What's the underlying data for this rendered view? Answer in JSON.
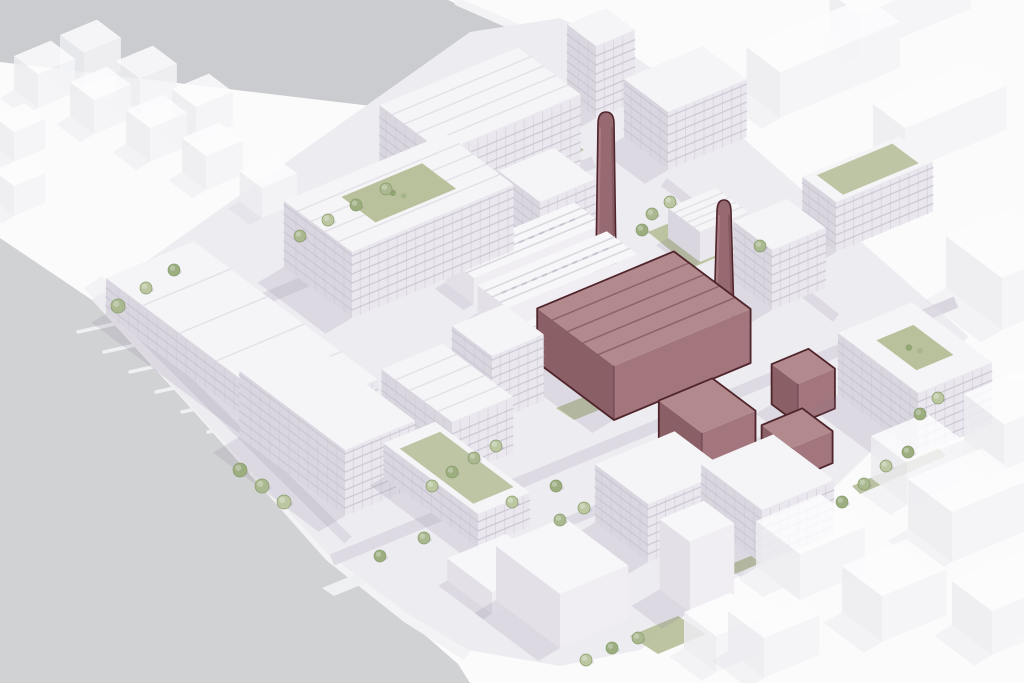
{
  "meta": {
    "kind": "architectural-axonometric-masterplan-rendering",
    "description_tokens": [
      "riverside-masterplan",
      "highlighted-heritage-power-station",
      "two-chimneys",
      "context-massing"
    ],
    "visible_text": []
  },
  "palette": {
    "background": "#fbfbfc",
    "water": "#d1d2d4",
    "top_band": "#c8c9cc",
    "quay": "#f3f2f4",
    "site_ground": "#edecf1",
    "street": "#dcd9e2",
    "lawn": "#b9c19c",
    "green_roof": "#bdc5a5",
    "tree_greens": [
      "#aab88f",
      "#bcc7a2",
      "#9cad80"
    ],
    "tree_stroke": "#879c6a",
    "building_top": "#f5f4f6",
    "building_se": "#eae8ee",
    "building_sw": "#d9d6df",
    "floor_band": "#c9c6d3",
    "mullion": "#c3c0cd",
    "massing_top": "#f7f6f8",
    "massing_se": "#f0eef3",
    "massing_sw": "#e3e0e8",
    "context_top": "#fdfdfe",
    "context_se": "#f5f5f8",
    "context_sw": "#ededf1",
    "roof_stripe": "#dedbe4",
    "shed_ridge": "#d8d5de",
    "skylight": "#b9b6c4",
    "highlight_top": "#b28a8e",
    "highlight_se": "#a2767c",
    "highlight_sw": "#8a5f66",
    "highlight_stripe": "#7c525a",
    "highlight_outline": "#4f242b",
    "chimney_fill": "#976a71",
    "chimney_light": "#ad8187",
    "chimney_dark": "#7b5158",
    "shadow": "rgba(128,120,150,0.16)"
  },
  "scene": {
    "canvas": {
      "w": 1024,
      "h": 683
    },
    "top_band": {
      "poly": [
        [
          0,
          0
        ],
        [
          448,
          0
        ],
        [
          676,
          102
        ],
        [
          608,
          134
        ],
        [
          0,
          62
        ]
      ],
      "stripe": [
        [
          458,
          2
        ],
        [
          690,
          103
        ]
      ]
    },
    "water": {
      "poly": [
        [
          0,
          238
        ],
        [
          92,
          300
        ],
        [
          330,
          560
        ],
        [
          410,
          622
        ],
        [
          458,
          664
        ],
        [
          470,
          683
        ],
        [
          0,
          683
        ]
      ]
    },
    "quay": {
      "poly": [
        [
          84,
          288
        ],
        [
          102,
          276
        ],
        [
          344,
          544
        ],
        [
          424,
          608
        ],
        [
          474,
          646
        ],
        [
          464,
          660
        ],
        [
          404,
          622
        ],
        [
          326,
          560
        ]
      ]
    },
    "piers": {
      "bases": [
        [
          114,
          324
        ],
        [
          140,
          344
        ],
        [
          166,
          364
        ],
        [
          192,
          384
        ],
        [
          218,
          404
        ],
        [
          244,
          424
        ],
        [
          270,
          444
        ]
      ],
      "dir": [
        -36,
        8
      ]
    },
    "steps": {
      "count": 5,
      "start": [
        386,
        566
      ],
      "step": [
        8,
        6
      ],
      "vec": [
        78,
        -33
      ]
    },
    "pontoons": [
      [
        [
          322,
          588
        ],
        [
          390,
          560
        ],
        [
          402,
          568
        ],
        [
          334,
          596
        ]
      ],
      [
        [
          530,
          654
        ],
        [
          596,
          626
        ],
        [
          608,
          634
        ],
        [
          542,
          662
        ]
      ]
    ],
    "ground": {
      "poly": [
        [
          92,
          300
        ],
        [
          470,
          32
        ],
        [
          560,
          18
        ],
        [
          612,
          42
        ],
        [
          700,
          100
        ],
        [
          968,
          336
        ],
        [
          930,
          394
        ],
        [
          760,
          560
        ],
        [
          640,
          650
        ],
        [
          560,
          666
        ],
        [
          468,
          650
        ],
        [
          408,
          614
        ],
        [
          328,
          554
        ]
      ]
    },
    "streets": [
      {
        "p1": [
          150,
          346
        ],
        "p2": [
          594,
          162
        ],
        "w": 12
      },
      {
        "p1": [
          332,
          560
        ],
        "p2": [
          956,
          302
        ],
        "w": 12
      },
      {
        "p1": [
          452,
          238
        ],
        "p2": [
          636,
          382
        ],
        "w": 10
      },
      {
        "p1": [
          252,
          312
        ],
        "p2": [
          430,
          448
        ],
        "w": 10
      },
      {
        "p1": [
          664,
          182
        ],
        "p2": [
          836,
          318
        ],
        "w": 10
      },
      {
        "p1": [
          548,
          530
        ],
        "p2": [
          770,
          438
        ],
        "w": 10
      },
      {
        "p1": [
          108,
          302
        ],
        "p2": [
          348,
          540
        ],
        "w": 10
      }
    ],
    "greens": [
      {
        "n": "north-courtyard-lawn",
        "poly": [
          [
            648,
            232
          ],
          [
            712,
            205
          ],
          [
            756,
            240
          ],
          [
            692,
            268
          ]
        ]
      },
      {
        "n": "south-lawn",
        "poly": [
          [
            630,
            636
          ],
          [
            678,
            616
          ],
          [
            706,
            634
          ],
          [
            658,
            654
          ]
        ]
      },
      {
        "n": "southeast-verge",
        "poly": [
          [
            712,
            572
          ],
          [
            804,
            534
          ],
          [
            812,
            542
          ],
          [
            720,
            580
          ]
        ]
      },
      {
        "n": "east-verge",
        "poly": [
          [
            852,
            486
          ],
          [
            938,
            448
          ],
          [
            946,
            456
          ],
          [
            860,
            494
          ]
        ]
      },
      {
        "n": "central-lawn",
        "poly": [
          [
            556,
            408
          ],
          [
            596,
            392
          ],
          [
            614,
            404
          ],
          [
            574,
            420
          ]
        ]
      },
      {
        "n": "upper-courtyard-lawn",
        "poly": [
          [
            520,
            150
          ],
          [
            560,
            134
          ],
          [
            584,
            150
          ],
          [
            544,
            166
          ]
        ]
      }
    ],
    "context_blocks": [
      [
        38,
        108,
        40,
        30,
        34
      ],
      [
        94,
        134,
        40,
        30,
        34
      ],
      [
        150,
        162,
        40,
        30,
        34
      ],
      [
        206,
        190,
        40,
        30,
        34
      ],
      [
        262,
        218,
        38,
        28,
        30
      ],
      [
        84,
        87,
        40,
        30,
        34
      ],
      [
        140,
        113,
        40,
        30,
        34
      ],
      [
        196,
        141,
        40,
        30,
        34
      ],
      [
        14,
        162,
        34,
        26,
        30
      ],
      [
        14,
        216,
        34,
        26,
        30
      ],
      [
        780,
        118,
        130,
        42,
        46
      ],
      [
        905,
        172,
        110,
        40,
        44
      ],
      [
        860,
        55,
        120,
        38,
        40
      ],
      [
        1002,
        330,
        70,
        70,
        52
      ],
      [
        800,
        600,
        70,
        55,
        46
      ],
      [
        882,
        642,
        70,
        50,
        46
      ],
      [
        952,
        562,
        80,
        55,
        50
      ],
      [
        907,
        505,
        60,
        45,
        42
      ],
      [
        1004,
        470,
        60,
        50,
        46
      ],
      [
        764,
        678,
        60,
        45,
        40
      ],
      [
        992,
        655,
        70,
        50,
        44
      ],
      [
        716,
        672,
        50,
        40,
        36
      ]
    ],
    "buildings": [
      {
        "n": "west-warehouses",
        "s": [
          290,
          452
        ],
        "a": 95,
        "b": 230,
        "h": 36,
        "st": "det",
        "fl": true,
        "roof": "gable"
      },
      {
        "n": "northwest-perimeter-block",
        "s": [
          352,
          318
        ],
        "a": 175,
        "b": 85,
        "h": 66,
        "st": "det",
        "fl": true,
        "roof": "gable",
        "ct": true
      },
      {
        "n": "northwest-upper-block",
        "s": [
          442,
          226
        ],
        "a": 150,
        "b": 78,
        "h": 74,
        "st": "det",
        "fl": true,
        "roof": "gable"
      },
      {
        "n": "north-tower",
        "s": [
          596,
          118
        ],
        "a": 42,
        "b": 36,
        "h": 72,
        "st": "det",
        "fl": true
      },
      {
        "n": "north-block",
        "s": [
          668,
          170
        ],
        "a": 85,
        "b": 55,
        "h": 58,
        "st": "det",
        "fl": true
      },
      {
        "n": "northeast-bar",
        "s": [
          836,
          252
        ],
        "a": 105,
        "b": 42,
        "h": 50,
        "st": "det",
        "fl": true,
        "gr": true
      },
      {
        "n": "northeast-block",
        "s": [
          772,
          310
        ],
        "a": 58,
        "b": 48,
        "h": 60,
        "st": "det",
        "fl": true
      },
      {
        "n": "east-perimeter-block",
        "s": [
          918,
          455
        ],
        "a": 80,
        "b": 100,
        "h": 62,
        "st": "det",
        "fl": true,
        "ct": true
      },
      {
        "n": "waterfront-slab",
        "s": [
          345,
          516
        ],
        "a": 76,
        "b": 132,
        "h": 66,
        "st": "det",
        "fl": true
      },
      {
        "n": "south-terraced-block",
        "s": [
          452,
          478
        ],
        "a": 66,
        "b": 88,
        "h": 56,
        "st": "det",
        "fl": true,
        "roof": "gable"
      },
      {
        "n": "south-green-roof-bar",
        "s": [
          478,
          548
        ],
        "a": 56,
        "b": 118,
        "h": 34,
        "st": "det",
        "fl": true,
        "gr": true
      },
      {
        "n": "southeast-block-a",
        "s": [
          648,
          562
        ],
        "a": 86,
        "b": 66,
        "h": 58,
        "st": "det",
        "fl": true
      },
      {
        "n": "southeast-block-b",
        "s": [
          762,
          564
        ],
        "a": 78,
        "b": 76,
        "h": 54,
        "st": "det",
        "fl": true
      },
      {
        "n": "central-midrise",
        "s": [
          492,
          422
        ],
        "a": 56,
        "b": 50,
        "h": 66,
        "st": "det",
        "fl": true
      },
      {
        "n": "industrial-shed-a",
        "s": [
          508,
          336
        ],
        "a": 140,
        "b": 38,
        "h": 28,
        "st": "massing",
        "roof": "shed"
      },
      {
        "n": "industrial-shed-b",
        "s": [
          474,
          304
        ],
        "a": 140,
        "b": 36,
        "h": 26,
        "st": "massing",
        "roof": "shed"
      },
      {
        "n": "industrial-shed-c",
        "s": [
          545,
          372
        ],
        "a": 80,
        "b": 34,
        "h": 26,
        "st": "massing",
        "roof": "shed"
      },
      {
        "n": "south-massing-large",
        "s": [
          560,
          648
        ],
        "a": 74,
        "b": 80,
        "h": 54,
        "st": "massing"
      },
      {
        "n": "south-massing-tower",
        "s": [
          690,
          612
        ],
        "a": 48,
        "b": 38,
        "h": 70,
        "st": "massing"
      },
      {
        "n": "south-massing-podium",
        "s": [
          492,
          614
        ],
        "a": 64,
        "b": 56,
        "h": 22,
        "st": "massing"
      },
      {
        "n": "courtyard-cottages",
        "s": [
          700,
          262
        ],
        "a": 52,
        "b": 40,
        "h": 30,
        "st": "det",
        "roof": "gable"
      },
      {
        "n": "north-mid-block",
        "s": [
          540,
          262
        ],
        "a": 60,
        "b": 52,
        "h": 60,
        "st": "det",
        "fl": true
      }
    ],
    "factory": {
      "halls": [
        {
          "n": "power-station-main-hall",
          "s": [
            614,
            420
          ],
          "a": 148,
          "b": 96,
          "h": 54,
          "st": "maroon",
          "roof": "gable"
        },
        {
          "n": "power-station-south-annex",
          "s": [
            702,
            477
          ],
          "a": 58,
          "b": 54,
          "h": 44,
          "st": "maroon"
        },
        {
          "n": "power-station-east-annex",
          "s": [
            798,
            424
          ],
          "a": 40,
          "b": 33,
          "h": 40,
          "st": "maroon"
        },
        {
          "n": "power-station-small-annex",
          "s": [
            792,
            480
          ],
          "a": 44,
          "b": 38,
          "h": 32,
          "st": "maroon"
        }
      ],
      "chimneys": [
        {
          "n": "chimney-west",
          "x": 606,
          "top": 112,
          "base": 330,
          "wt": 8,
          "wb": 11
        },
        {
          "n": "chimney-east",
          "x": 724,
          "top": 200,
          "base": 316,
          "wt": 7,
          "wb": 10
        }
      ]
    },
    "trees": [
      [
        118,
        306,
        7
      ],
      [
        146,
        288,
        6
      ],
      [
        174,
        270,
        6
      ],
      [
        300,
        236,
        6
      ],
      [
        328,
        220,
        6
      ],
      [
        356,
        205,
        6
      ],
      [
        386,
        189,
        6
      ],
      [
        432,
        486,
        6
      ],
      [
        452,
        472,
        6
      ],
      [
        474,
        458,
        6
      ],
      [
        496,
        446,
        6
      ],
      [
        240,
        470,
        7
      ],
      [
        262,
        486,
        7
      ],
      [
        284,
        502,
        7
      ],
      [
        380,
        556,
        6
      ],
      [
        424,
        538,
        6
      ],
      [
        512,
        502,
        6
      ],
      [
        556,
        486,
        6
      ],
      [
        560,
        520,
        6
      ],
      [
        584,
        508,
        6
      ],
      [
        612,
        648,
        6
      ],
      [
        638,
        638,
        6
      ],
      [
        586,
        660,
        6
      ],
      [
        842,
        502,
        6
      ],
      [
        864,
        484,
        6
      ],
      [
        886,
        466,
        6
      ],
      [
        908,
        452,
        6
      ],
      [
        652,
        214,
        6
      ],
      [
        670,
        202,
        6
      ],
      [
        642,
        230,
        6
      ],
      [
        760,
        246,
        6
      ],
      [
        938,
        398,
        6
      ],
      [
        920,
        414,
        6
      ]
    ]
  }
}
